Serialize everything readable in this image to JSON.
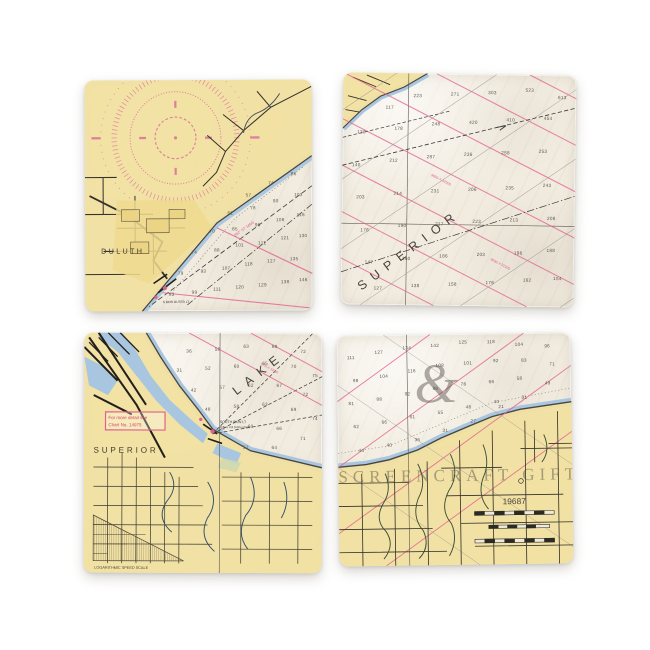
{
  "colors": {
    "land": "#f1e0a0",
    "land_deep": "#ecd88e",
    "water": "#f5f0e6",
    "shallow": "#a9c6e0",
    "magenta": "#e0608e",
    "ink": "#36332c",
    "red_note": "#d2485f"
  },
  "coasters": {
    "top_left": {
      "labels": {
        "city": "DULUTH",
        "course": "252° 57' MAG",
        "light1": "S BKW OUTER LT"
      },
      "soundings": [
        {
          "x": 72,
          "y": 50,
          "v": "57"
        },
        {
          "x": 82,
          "y": 45,
          "v": "74"
        },
        {
          "x": 92,
          "y": 41,
          "v": "86"
        },
        {
          "x": 64,
          "y": 58,
          "v": "62"
        },
        {
          "x": 74,
          "y": 56,
          "v": "78"
        },
        {
          "x": 84,
          "y": 53,
          "v": "90"
        },
        {
          "x": 94,
          "y": 50,
          "v": "103"
        },
        {
          "x": 56,
          "y": 66,
          "v": "70"
        },
        {
          "x": 66,
          "y": 65,
          "v": "85"
        },
        {
          "x": 76,
          "y": 63,
          "v": "96"
        },
        {
          "x": 86,
          "y": 61,
          "v": "108"
        },
        {
          "x": 95,
          "y": 59,
          "v": "116"
        },
        {
          "x": 48,
          "y": 75,
          "v": "74"
        },
        {
          "x": 58,
          "y": 74,
          "v": "88"
        },
        {
          "x": 68,
          "y": 72,
          "v": "101"
        },
        {
          "x": 78,
          "y": 71,
          "v": "112"
        },
        {
          "x": 88,
          "y": 69,
          "v": "121"
        },
        {
          "x": 96,
          "y": 68,
          "v": "130"
        },
        {
          "x": 42,
          "y": 84,
          "v": "79"
        },
        {
          "x": 52,
          "y": 83,
          "v": "93"
        },
        {
          "x": 62,
          "y": 82,
          "v": "107"
        },
        {
          "x": 72,
          "y": 80,
          "v": "118"
        },
        {
          "x": 82,
          "y": 79,
          "v": "127"
        },
        {
          "x": 92,
          "y": 78,
          "v": "135"
        },
        {
          "x": 38,
          "y": 93,
          "v": "83"
        },
        {
          "x": 48,
          "y": 92,
          "v": "99"
        },
        {
          "x": 58,
          "y": 91,
          "v": "111"
        },
        {
          "x": 68,
          "y": 90,
          "v": "120"
        },
        {
          "x": 78,
          "y": 89,
          "v": "129"
        },
        {
          "x": 88,
          "y": 88,
          "v": "138"
        },
        {
          "x": 96,
          "y": 87,
          "v": "146"
        }
      ]
    },
    "top_right": {
      "labels": {
        "lake_word": "SUPERIOR",
        "loran1": "9930-X-32000",
        "loran2": "9930-Y-31500"
      },
      "soundings": [
        {
          "x": 20,
          "y": 15,
          "v": "117"
        },
        {
          "x": 32,
          "y": 10,
          "v": "223"
        },
        {
          "x": 48,
          "y": 9,
          "v": "271"
        },
        {
          "x": 64,
          "y": 8,
          "v": "303"
        },
        {
          "x": 80,
          "y": 7,
          "v": "523"
        },
        {
          "x": 94,
          "y": 10,
          "v": "613"
        },
        {
          "x": 8,
          "y": 26,
          "v": "130"
        },
        {
          "x": 24,
          "y": 24,
          "v": "178"
        },
        {
          "x": 40,
          "y": 22,
          "v": "248"
        },
        {
          "x": 56,
          "y": 21,
          "v": "420"
        },
        {
          "x": 72,
          "y": 20,
          "v": "410"
        },
        {
          "x": 88,
          "y": 19,
          "v": "454"
        },
        {
          "x": 6,
          "y": 40,
          "v": "140"
        },
        {
          "x": 22,
          "y": 38,
          "v": "212"
        },
        {
          "x": 38,
          "y": 36,
          "v": "287"
        },
        {
          "x": 54,
          "y": 35,
          "v": "236"
        },
        {
          "x": 70,
          "y": 34,
          "v": "258"
        },
        {
          "x": 86,
          "y": 33,
          "v": "253"
        },
        {
          "x": 8,
          "y": 54,
          "v": "203"
        },
        {
          "x": 24,
          "y": 52,
          "v": "214"
        },
        {
          "x": 40,
          "y": 51,
          "v": "231"
        },
        {
          "x": 56,
          "y": 50,
          "v": "206"
        },
        {
          "x": 72,
          "y": 49,
          "v": "235"
        },
        {
          "x": 88,
          "y": 48,
          "v": "243"
        },
        {
          "x": 10,
          "y": 68,
          "v": "176"
        },
        {
          "x": 26,
          "y": 66,
          "v": "190"
        },
        {
          "x": 42,
          "y": 65,
          "v": "217"
        },
        {
          "x": 58,
          "y": 64,
          "v": "223"
        },
        {
          "x": 74,
          "y": 63,
          "v": "213"
        },
        {
          "x": 90,
          "y": 62,
          "v": "208"
        },
        {
          "x": 12,
          "y": 82,
          "v": "147"
        },
        {
          "x": 28,
          "y": 80,
          "v": "160"
        },
        {
          "x": 44,
          "y": 79,
          "v": "186"
        },
        {
          "x": 60,
          "y": 78,
          "v": "203"
        },
        {
          "x": 76,
          "y": 77,
          "v": "196"
        },
        {
          "x": 90,
          "y": 76,
          "v": "188"
        },
        {
          "x": 16,
          "y": 93,
          "v": "127"
        },
        {
          "x": 32,
          "y": 92,
          "v": "138"
        },
        {
          "x": 48,
          "y": 91,
          "v": "158"
        },
        {
          "x": 64,
          "y": 90,
          "v": "176"
        },
        {
          "x": 80,
          "y": 89,
          "v": "162"
        },
        {
          "x": 93,
          "y": 88,
          "v": "154"
        }
      ]
    },
    "bottom_left": {
      "labels": {
        "city": "SUPERIOR",
        "lake_word": "LAKE",
        "note_line1": "For more detail see",
        "note_line2": "Chart No. 14975",
        "light1": "SOUTH BKW LT",
        "light1_detail": "Fl G 4s 52ft 26StM HORN",
        "loran1": "9930-X-32000",
        "scale_caption": "LOGARITHMIC SPEED SCALE"
      },
      "soundings": [
        {
          "x": 44,
          "y": 8,
          "v": "36"
        },
        {
          "x": 56,
          "y": 7,
          "v": "58"
        },
        {
          "x": 68,
          "y": 6,
          "v": "63"
        },
        {
          "x": 80,
          "y": 6,
          "v": "68"
        },
        {
          "x": 92,
          "y": 8,
          "v": "72"
        },
        {
          "x": 40,
          "y": 16,
          "v": "31"
        },
        {
          "x": 52,
          "y": 15,
          "v": "52"
        },
        {
          "x": 64,
          "y": 14,
          "v": "60"
        },
        {
          "x": 76,
          "y": 13,
          "v": "65"
        },
        {
          "x": 88,
          "y": 14,
          "v": "70"
        },
        {
          "x": 97,
          "y": 18,
          "v": "75"
        },
        {
          "x": 46,
          "y": 24,
          "v": "42"
        },
        {
          "x": 58,
          "y": 23,
          "v": "57"
        },
        {
          "x": 70,
          "y": 22,
          "v": "62"
        },
        {
          "x": 82,
          "y": 22,
          "v": "67"
        },
        {
          "x": 93,
          "y": 26,
          "v": "72"
        },
        {
          "x": 52,
          "y": 32,
          "v": "48"
        },
        {
          "x": 64,
          "y": 31,
          "v": "58"
        },
        {
          "x": 76,
          "y": 30,
          "v": "63"
        },
        {
          "x": 88,
          "y": 32,
          "v": "69"
        },
        {
          "x": 97,
          "y": 36,
          "v": "74"
        },
        {
          "x": 58,
          "y": 40,
          "v": "53"
        },
        {
          "x": 70,
          "y": 39,
          "v": "60"
        },
        {
          "x": 82,
          "y": 40,
          "v": "66"
        },
        {
          "x": 92,
          "y": 44,
          "v": "71"
        },
        {
          "x": 68,
          "y": 48,
          "v": "57"
        },
        {
          "x": 80,
          "y": 48,
          "v": "64"
        }
      ]
    },
    "bottom_right": {
      "labels": {
        "chart_number": "19687",
        "watermark_logo": "&",
        "watermark_text": "SCREENCRAFT GIFTS"
      },
      "soundings": [
        {
          "x": 6,
          "y": 10,
          "v": "111"
        },
        {
          "x": 18,
          "y": 8,
          "v": "127"
        },
        {
          "x": 30,
          "y": 6,
          "v": "134"
        },
        {
          "x": 42,
          "y": 5,
          "v": "142"
        },
        {
          "x": 54,
          "y": 4,
          "v": "125"
        },
        {
          "x": 66,
          "y": 4,
          "v": "118"
        },
        {
          "x": 78,
          "y": 5,
          "v": "104"
        },
        {
          "x": 90,
          "y": 6,
          "v": "96"
        },
        {
          "x": 8,
          "y": 20,
          "v": "98"
        },
        {
          "x": 20,
          "y": 18,
          "v": "104"
        },
        {
          "x": 32,
          "y": 16,
          "v": "116"
        },
        {
          "x": 44,
          "y": 14,
          "v": "108"
        },
        {
          "x": 56,
          "y": 13,
          "v": "101"
        },
        {
          "x": 68,
          "y": 12,
          "v": "92"
        },
        {
          "x": 80,
          "y": 12,
          "v": "83"
        },
        {
          "x": 92,
          "y": 14,
          "v": "71"
        },
        {
          "x": 6,
          "y": 30,
          "v": "81"
        },
        {
          "x": 18,
          "y": 28,
          "v": "88"
        },
        {
          "x": 30,
          "y": 26,
          "v": "92"
        },
        {
          "x": 42,
          "y": 24,
          "v": "86"
        },
        {
          "x": 54,
          "y": 22,
          "v": "78"
        },
        {
          "x": 66,
          "y": 21,
          "v": "66"
        },
        {
          "x": 78,
          "y": 20,
          "v": "58"
        },
        {
          "x": 90,
          "y": 22,
          "v": "49"
        },
        {
          "x": 8,
          "y": 40,
          "v": "62"
        },
        {
          "x": 20,
          "y": 38,
          "v": "66"
        },
        {
          "x": 32,
          "y": 36,
          "v": "61"
        },
        {
          "x": 44,
          "y": 34,
          "v": "55"
        },
        {
          "x": 56,
          "y": 32,
          "v": "48"
        },
        {
          "x": 68,
          "y": 30,
          "v": "40"
        },
        {
          "x": 80,
          "y": 28,
          "v": "31"
        },
        {
          "x": 10,
          "y": 50,
          "v": "44"
        },
        {
          "x": 22,
          "y": 48,
          "v": "40"
        },
        {
          "x": 34,
          "y": 46,
          "v": "36"
        },
        {
          "x": 46,
          "y": 42,
          "v": "31"
        },
        {
          "x": 58,
          "y": 38,
          "v": "27"
        },
        {
          "x": 70,
          "y": 32,
          "v": "21"
        }
      ]
    }
  }
}
